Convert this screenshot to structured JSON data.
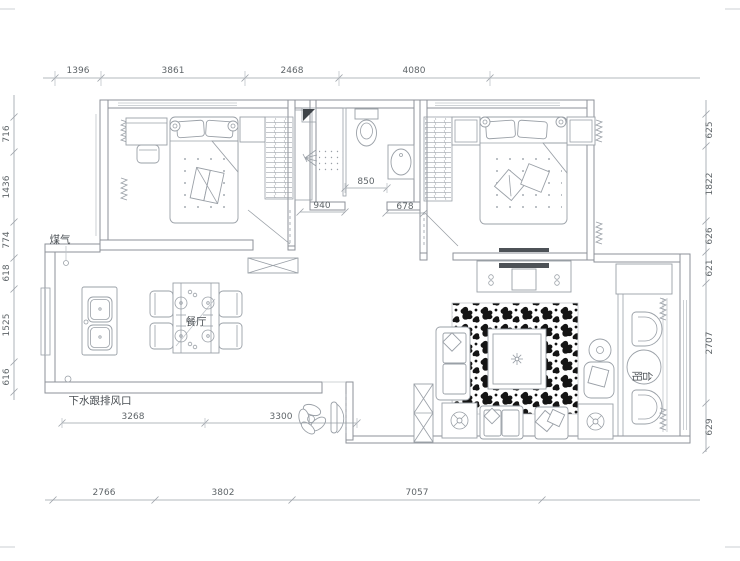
{
  "plan": {
    "room_labels": {
      "dining": "餐厅",
      "balcony": "阳台"
    },
    "annotations": {
      "gas": "煤气",
      "drain_vent": "下水跟排风口"
    },
    "dims": {
      "top": [
        "1396",
        "3861",
        "2468",
        "4080"
      ],
      "left": [
        "716",
        "1436",
        "774",
        "618",
        "1525",
        "616"
      ],
      "right": [
        "625",
        "1822",
        "626",
        "621",
        "2707",
        "629"
      ],
      "bottom": [
        "2766",
        "3802",
        "7057"
      ],
      "interior": {
        "bath": "850",
        "hall_left": "940",
        "hall_right": "678",
        "south_left": "3268",
        "south_right": "3300"
      }
    },
    "colors": {
      "line": "#8d9299",
      "furniture": "#9aa0a7",
      "dim_text": "#5f6569",
      "rug_pattern": "#141414",
      "background": "#ffffff"
    }
  }
}
